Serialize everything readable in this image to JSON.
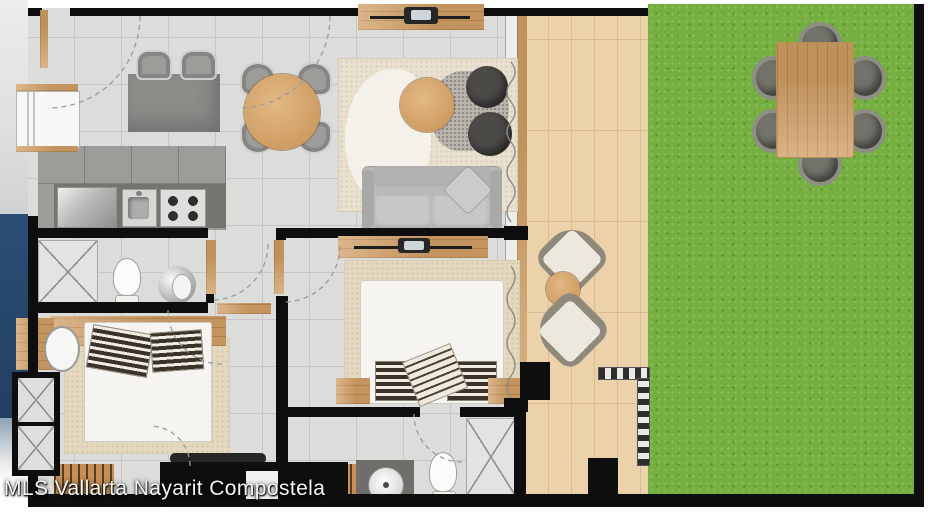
{
  "watermark": {
    "text": "MLS Vallarta Nayarit Compostela"
  },
  "colors": {
    "wall": "#0e0e0e",
    "floor": "#dcdcdb",
    "floor_line": "#c6c6c4",
    "floor_dark": "#9e9c98",
    "wood": "#cf9d63",
    "wood_light": "#e7cba2",
    "deck": "#ecd2ab",
    "deck_line": "#dbbb90",
    "grass": "#74af40",
    "pool": "#2b4e75",
    "island": "#8d8c89",
    "counter": "#76746f",
    "steel": "#d7d7d5",
    "sofa": "#bab9b7",
    "pouf": "#4c4a47",
    "rug": "#e9e1cf",
    "rug_bedroom": "#e4d9be",
    "bed": "#f6f4f0",
    "pillow_dark": "#3b3229",
    "chair": "#9c9c99",
    "tv": "#262626"
  }
}
